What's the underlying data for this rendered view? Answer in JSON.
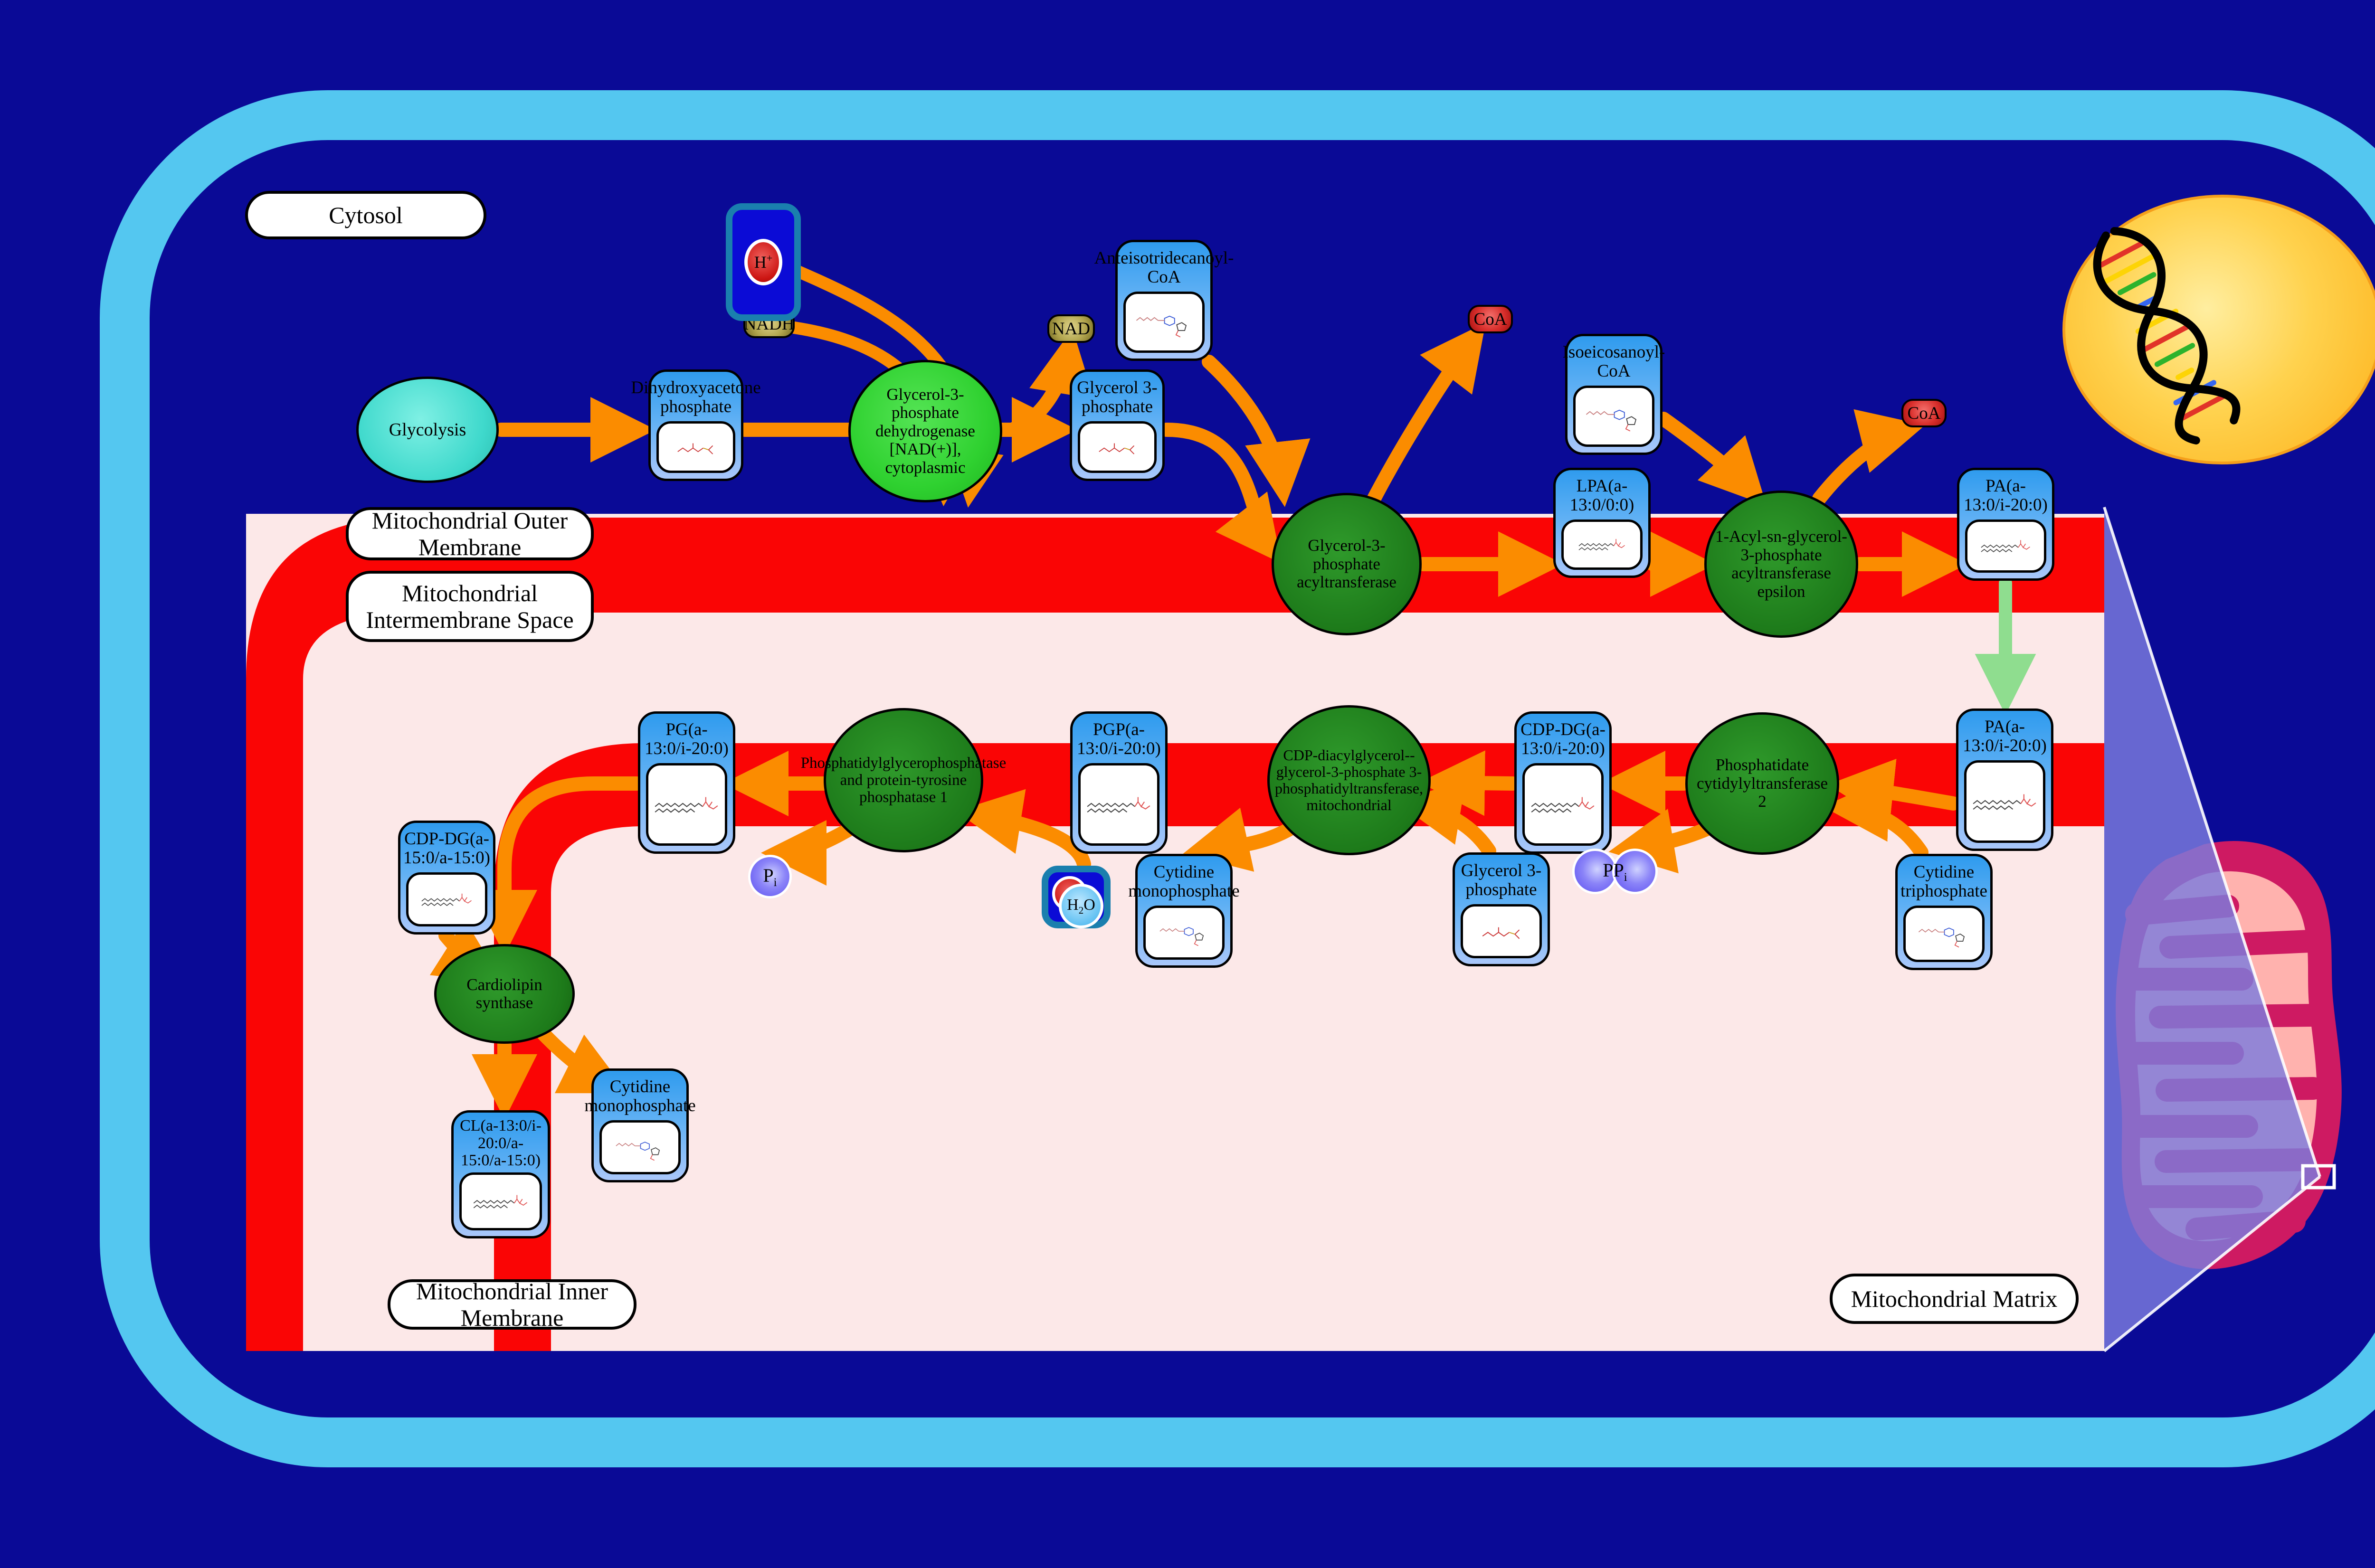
{
  "regions": {
    "cytosol": "Cytosol",
    "outer_membrane": "Mitochondrial Outer Membrane",
    "intermembrane": "Mitochondrial Intermembrane Space",
    "inner_membrane": "Mitochondrial Inner Membrane",
    "matrix": "Mitochondrial Matrix"
  },
  "pathway_source": "Glycolysis",
  "metabolites": {
    "dhap": "Dihydroxyacetone phosphate",
    "g3p_cytosol": "Glycerol 3-phosphate",
    "atd_coa": "Anteisotridecanoyl-CoA",
    "iso_coa": "Isoeicosanoyl-CoA",
    "lpa": "LPA(a-13:0/0:0)",
    "pa_outer": "PA(a-13:0/i-20:0)",
    "pa_inner": "PA(a-13:0/i-20:0)",
    "cdp_dg_1": "CDP-DG(a-13:0/i-20:0)",
    "pgp": "PGP(a-13:0/i-20:0)",
    "pg": "PG(a-13:0/i-20:0)",
    "cdp_dg_2": "CDP-DG(a-15:0/a-15:0)",
    "cl": "CL(a-13:0/i-20:0/a-15:0/a-15:0)",
    "cmp_mid": "Cytidine monophosphate",
    "cmp_left": "Cytidine monophosphate",
    "g3p_matrix": "Glycerol 3-phosphate",
    "ctp": "Cytidine triphosphate"
  },
  "enzymes": {
    "gpd_cytoplasmic": "Glycerol-3-phosphate dehydrogenase [NAD(+)], cytoplasmic",
    "gpat": "Glycerol-3-phosphate acyltransferase",
    "agpat_epsilon": "1-Acyl-sn-glycerol-3-phosphate acyltransferase epsilon",
    "pct2": "Phosphatidate cytidylyltransferase 2",
    "pgps": "CDP-diacylglycerol--glycerol-3-phosphate 3-phosphatidyltransferase, mitochondrial",
    "ptpmt1": "Phosphatidylglycerophosphatase and protein-tyrosine phosphatase 1",
    "cls": "Cardiolipin synthase"
  },
  "cofactors": {
    "nadh": "NADH",
    "nad": "NAD",
    "coa_1": "CoA",
    "coa_2": "CoA",
    "h_plus": {
      "base": "H",
      "sup": "+"
    },
    "h2o": {
      "h": "H",
      "sub": "2",
      "o": "O"
    },
    "pi": {
      "base": "P",
      "sub": "i"
    },
    "ppi": {
      "base": "PP",
      "sub": "i"
    }
  },
  "colors": {
    "background_navy": "#0a0a96",
    "cell_border_cyan": "#54c7f0",
    "canvas_pink": "#fce8e8",
    "membrane_red": "#fa0505",
    "arrow_orange": "#fb8c00",
    "transport_arrow_green": "#8fdd8f",
    "metabolite_box_blue": "#2f9bee",
    "enzyme_green_dark": "#1d7a1a",
    "enzyme_green_bright": "#2fd130",
    "source_ellipse_turquoise": "#3fd9cc",
    "cofactor_olive": "#b3a750",
    "cofactor_red": "#d92f2c",
    "inorganic_purple": "#7b71f5",
    "nucleus_yellow": "#ffd24e",
    "mitochondrion_crimson": "#ce1a62",
    "mitochondrion_matrix_pink": "#ffb2ae",
    "callout_periwinkle": "#6e6ed0"
  }
}
